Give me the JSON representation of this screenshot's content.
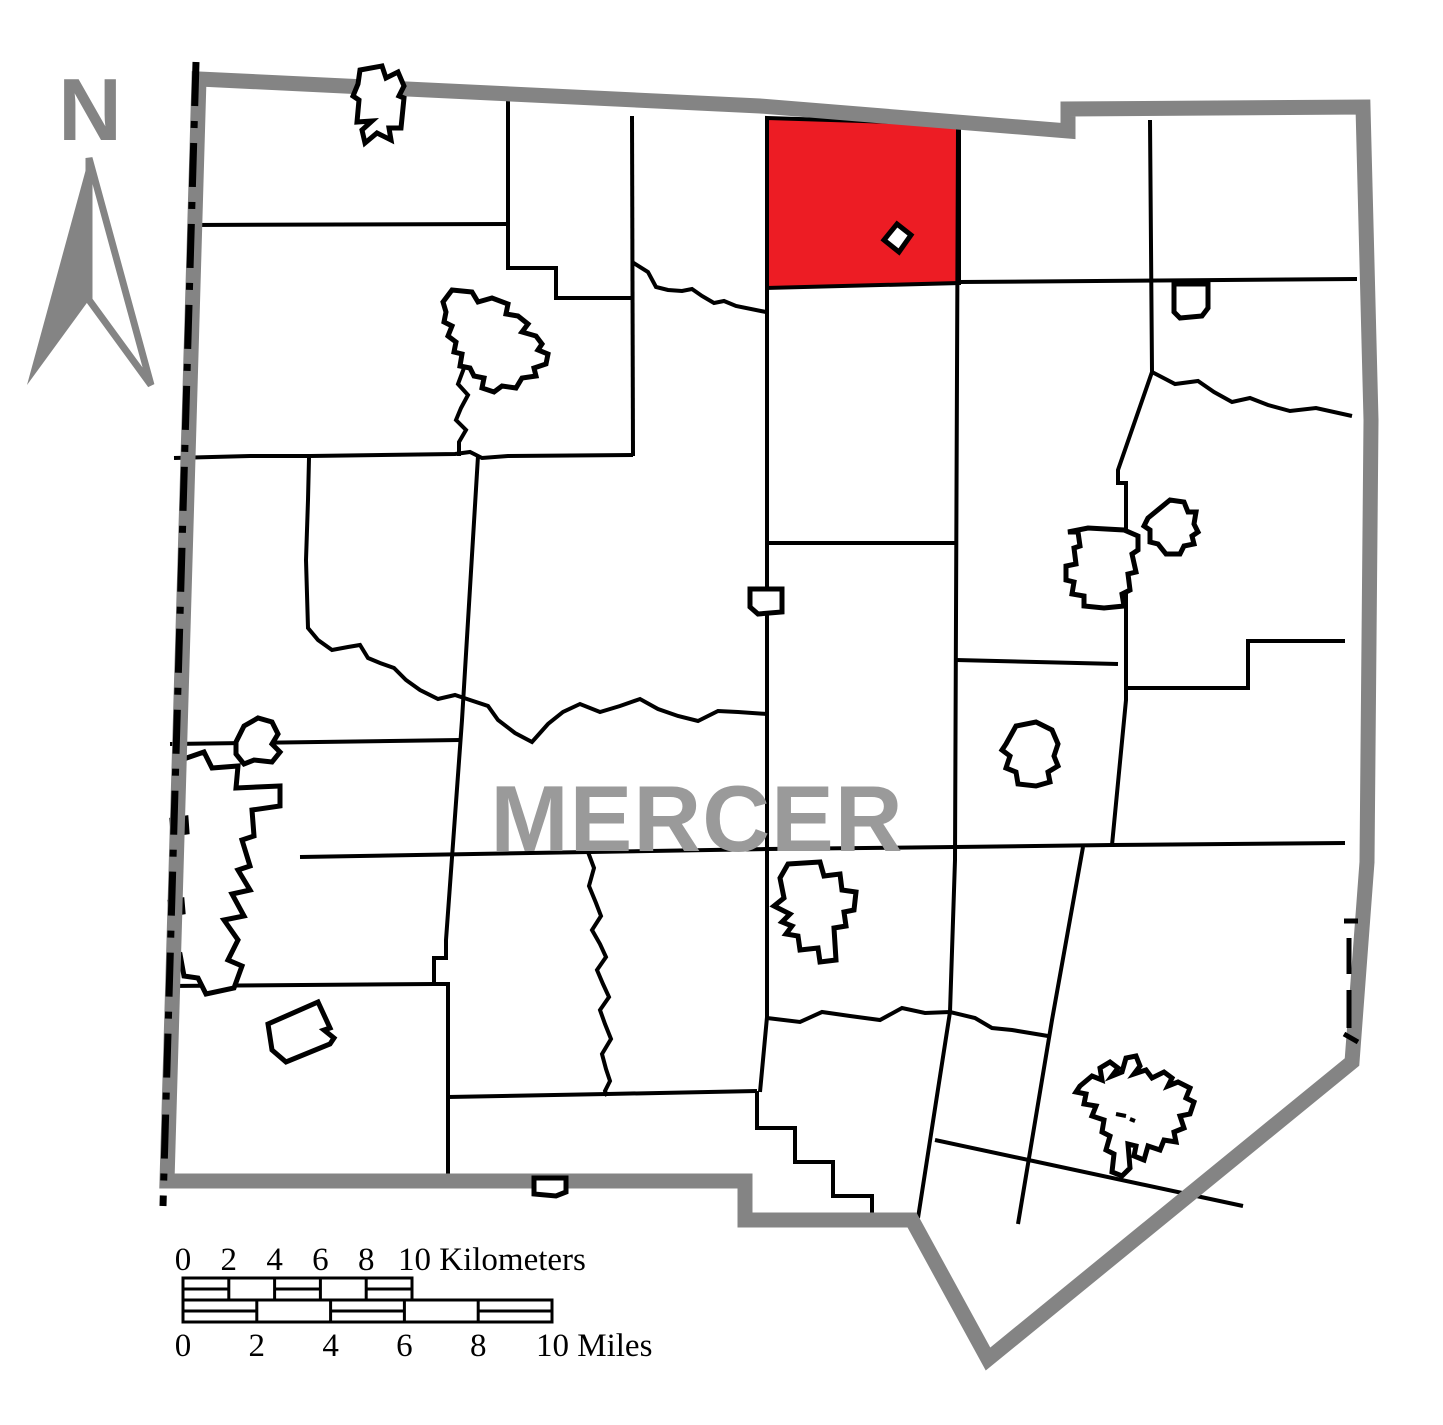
{
  "map": {
    "county_label": "MERCER",
    "north_label": "N",
    "colors": {
      "highlight_red": "#ed1c24",
      "county_border_gray": "#848484",
      "boundary_black": "#000000",
      "county_label_gray": "#9a9a9a"
    }
  },
  "scalebar": {
    "km": {
      "ticks": [
        "0",
        "2",
        "4",
        "6",
        "8"
      ],
      "end_label": "10 Kilometers"
    },
    "miles": {
      "ticks": [
        "0",
        "2",
        "4",
        "6",
        "8"
      ],
      "end_label": "10 Miles"
    }
  }
}
